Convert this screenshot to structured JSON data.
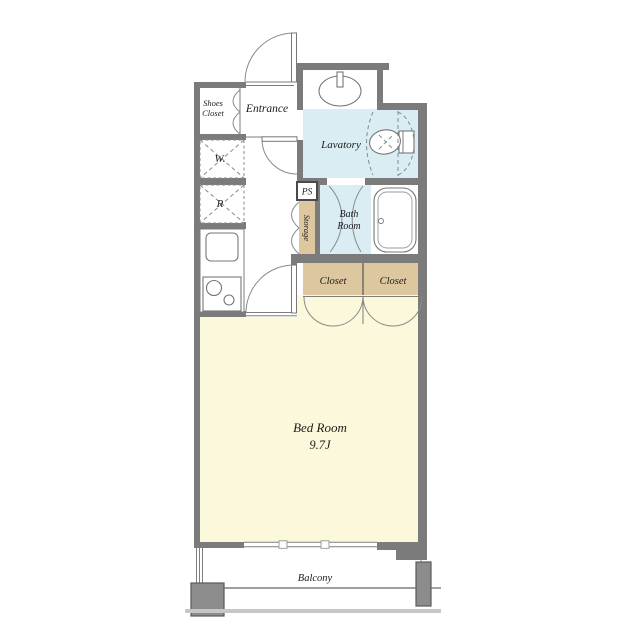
{
  "title": "apartment-floor-plan",
  "colors": {
    "wall": "#7b7b7b",
    "wet": "#d9edf3",
    "closet": "#dcc79e",
    "bedroom": "#fbf8dc",
    "pillar": "#8c8c8c",
    "railing_light": "#c7c7c7"
  },
  "rooms": {
    "shoes_closet": {
      "line1": "Shoes",
      "line2": "Closet"
    },
    "entrance": {
      "label": "Entrance"
    },
    "lavatory": {
      "label": "Lavatory"
    },
    "bath_room": {
      "line1": "Bath",
      "line2": "Room"
    },
    "ps": {
      "label": "PS"
    },
    "storage": {
      "label": "Storage"
    },
    "washer": {
      "label": "W."
    },
    "refrigerator": {
      "label": "R"
    },
    "closet_left": {
      "label": "Closet"
    },
    "closet_right": {
      "label": "Closet"
    },
    "bed_room": {
      "label": "Bed Room",
      "size": "9.7J"
    },
    "balcony": {
      "label": "Balcony"
    }
  }
}
